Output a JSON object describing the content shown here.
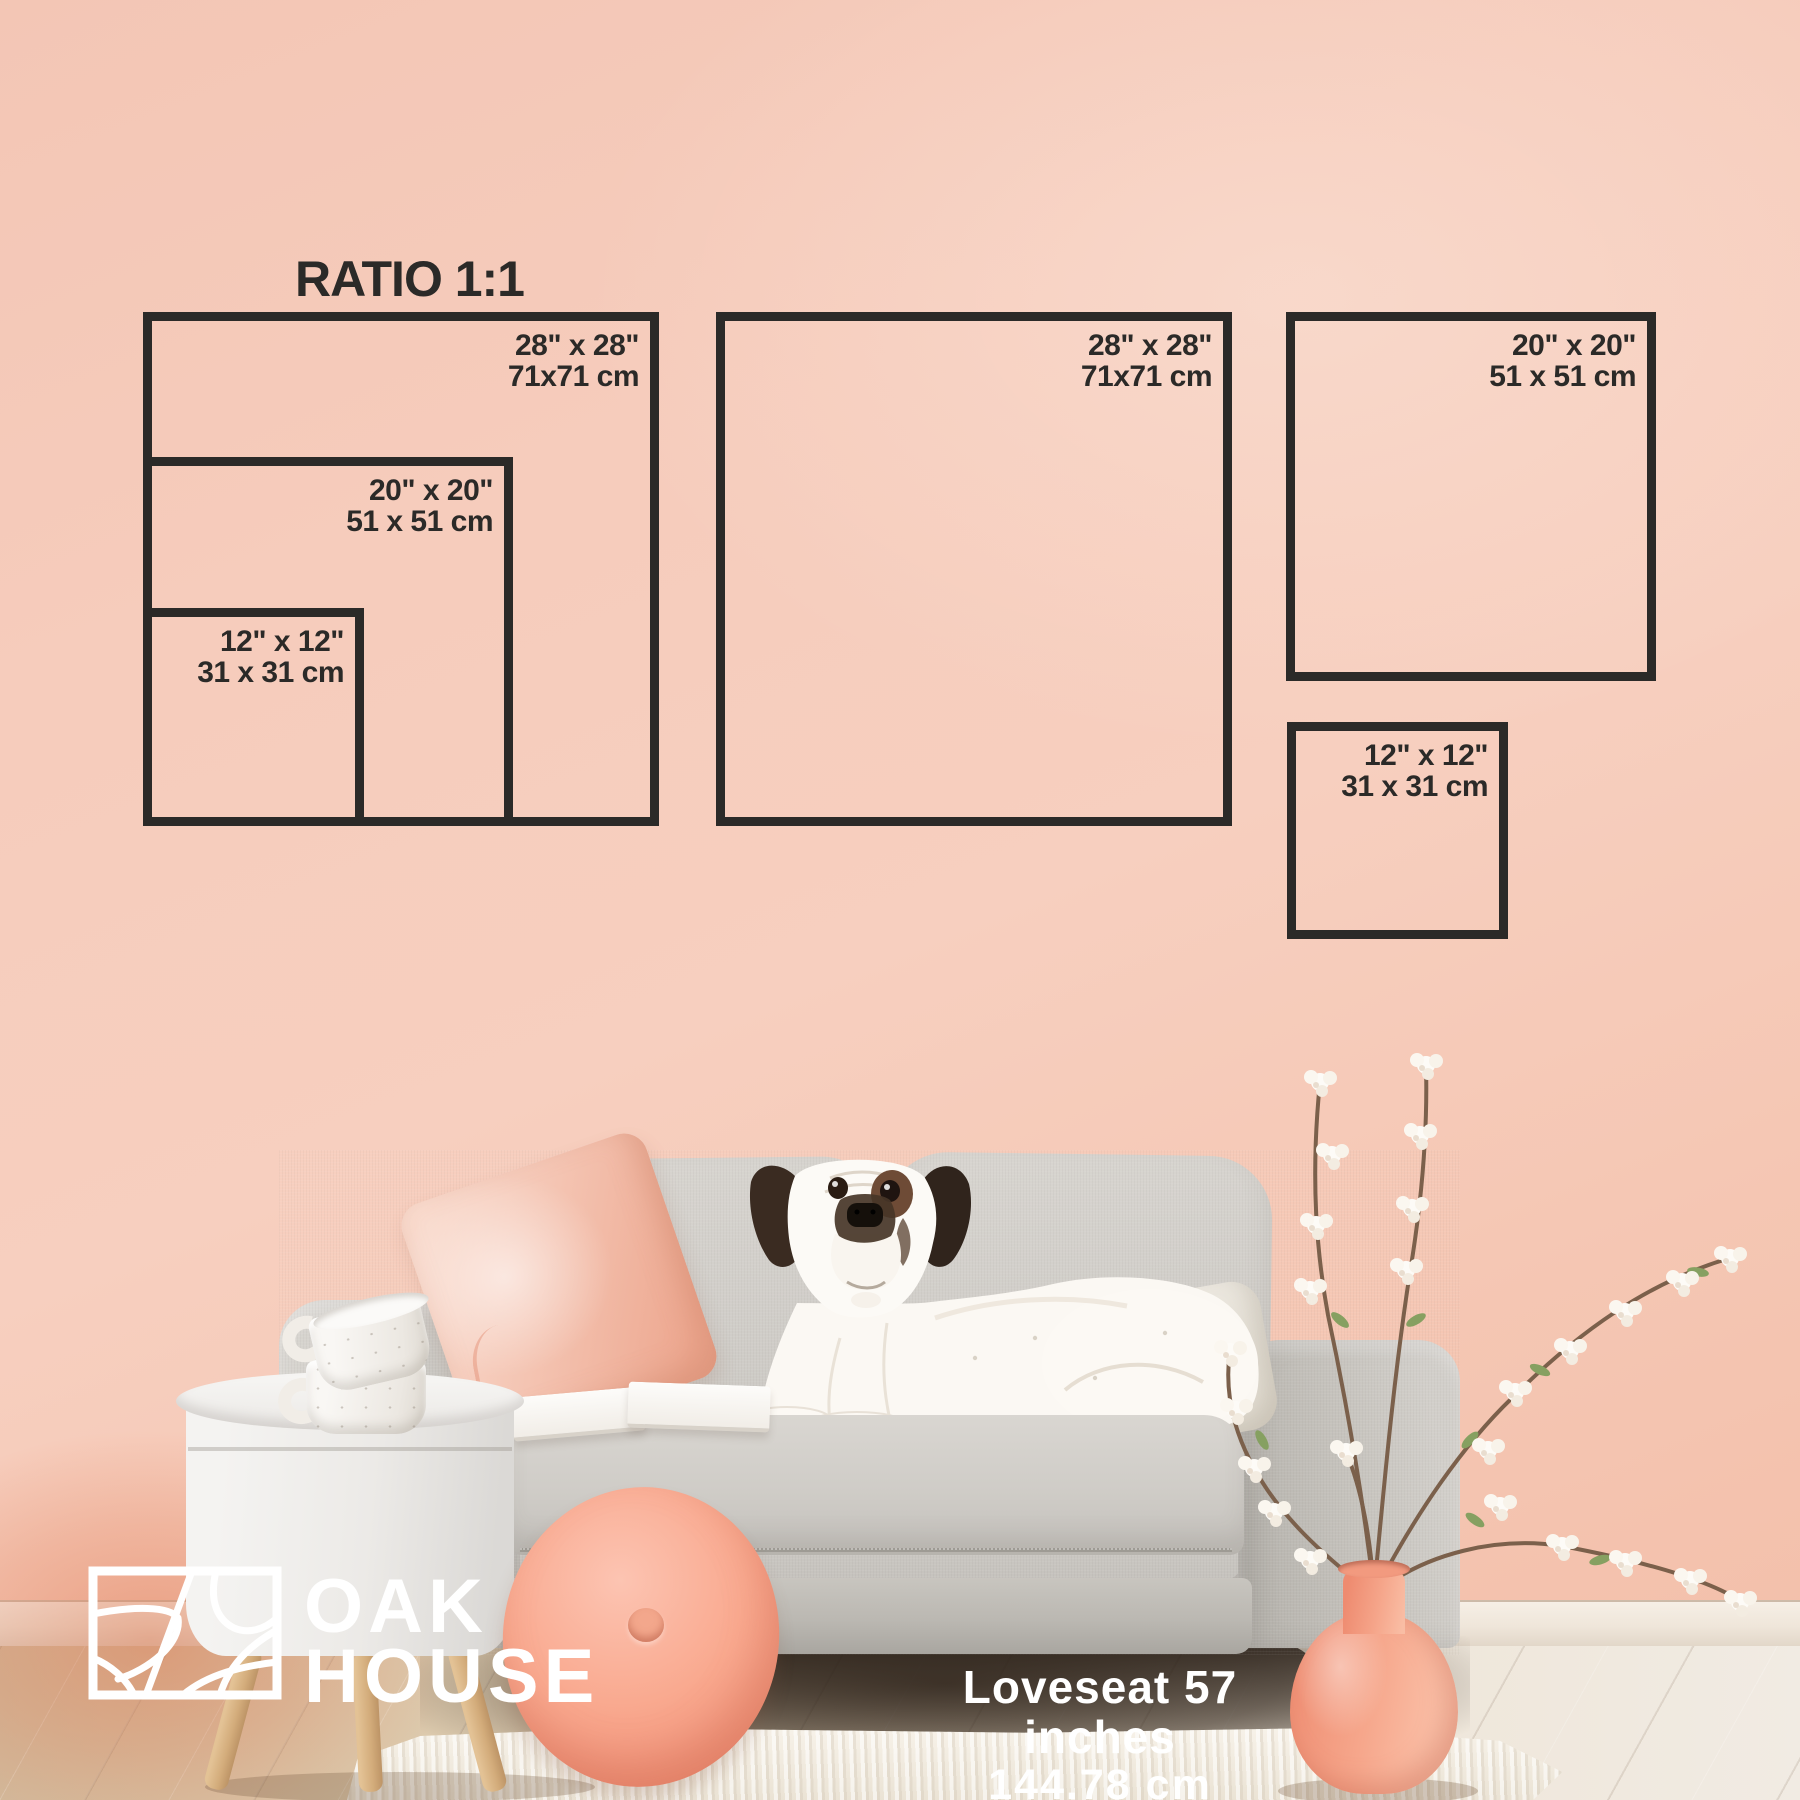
{
  "title": "RATIO 1:1",
  "squares": [
    {
      "position": "left-outer",
      "inches": "28\" x 28\"",
      "cm": "71x71 cm"
    },
    {
      "position": "left-middle",
      "inches": "20\" x 20\"",
      "cm": "51 x 51 cm"
    },
    {
      "position": "left-inner",
      "inches": "12\" x 12\"",
      "cm": "31 x 31 cm"
    },
    {
      "position": "center",
      "inches": "28\" x 28\"",
      "cm": "71x71 cm"
    },
    {
      "position": "right-top",
      "inches": "20\" x 20\"",
      "cm": "51 x 51 cm"
    },
    {
      "position": "right-bottom",
      "inches": "12\" x 12\"",
      "cm": "31 x 31 cm"
    }
  ],
  "brand": {
    "line1": "OAK",
    "line2": "HOUSE"
  },
  "caption": {
    "line1": "Loveseat 57 inches",
    "line2": "144.78 cm"
  },
  "colors": {
    "outline": "#2b2a28",
    "wall": "#f6ccbc",
    "accent_coral": "#f4a58d",
    "sofa_grey": "#cdcac4",
    "floor_wood": "#e2d2ba",
    "text_light": "#ffffff"
  }
}
